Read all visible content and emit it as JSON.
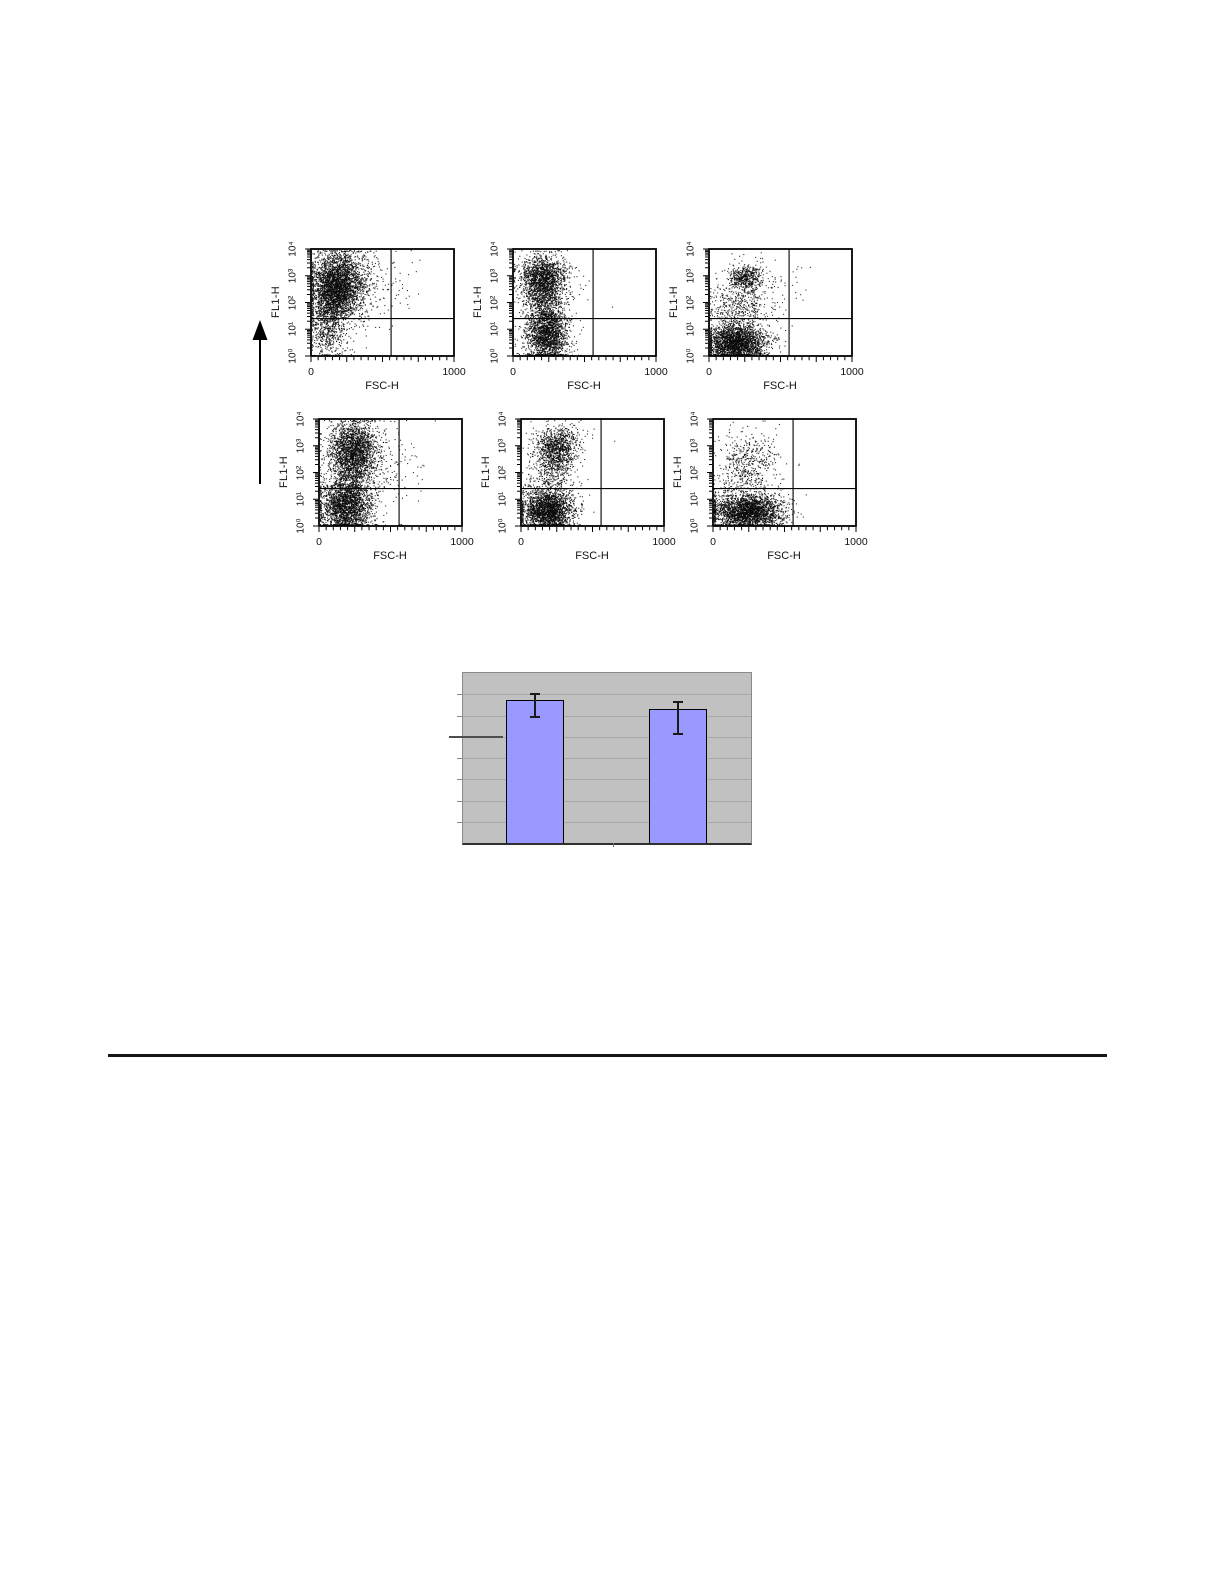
{
  "colors": {
    "page_bg": "#ffffff",
    "dot": "#0a0a0a",
    "plot_frame": "#111111",
    "bar_fill": "#9999ff",
    "bar_border": "#000000",
    "chart_bg": "#c1c1c1",
    "chart_border": "#8a8a8a",
    "gridline": "#a9a9a9",
    "separator": "#151515"
  },
  "chart_data": [
    {
      "type": "scatter",
      "subtype": "flow-cytometry-dot-plots",
      "layout_grid": "2 rows x 3 columns",
      "xlabel": "FSC-H",
      "ylabel": "FL1-H",
      "x_range": [
        0,
        1000
      ],
      "x_tick_labels": [
        "0",
        "1000"
      ],
      "y_scale": "log",
      "y_log_range": [
        0,
        4
      ],
      "y_tick_labels": [
        "10⁰",
        "10¹",
        "10²",
        "10³",
        "10⁴"
      ],
      "quadrant_gate": {
        "x": 560,
        "y_log": 1.4
      },
      "plots": [
        {
          "name": "row1-col1",
          "seed": 7,
          "clusters": [
            {
              "n": 2400,
              "cx": 185,
              "sx": 90,
              "ly": 2.75,
              "sly": 0.5
            },
            {
              "n": 900,
              "cx": 150,
              "sx": 75,
              "ly": 1.9,
              "sly": 0.45
            },
            {
              "n": 300,
              "cx": 100,
              "sx": 55,
              "ly": 1.0,
              "sly": 0.45
            },
            {
              "n": 90,
              "cx": 170,
              "sx": 60,
              "ly": 0.5,
              "sly": 0.3
            },
            {
              "n": 260,
              "cx": 330,
              "sx": 95,
              "ly": 2.5,
              "sly": 0.8
            },
            {
              "n": 120,
              "cx": 200,
              "sx": 90,
              "ly": 3.6,
              "sly": 0.25
            },
            {
              "n": 40,
              "cx": 600,
              "sx": 90,
              "ly": 2.8,
              "sly": 0.6
            }
          ]
        },
        {
          "name": "row1-col2",
          "seed": 13,
          "clusters": [
            {
              "n": 1500,
              "cx": 205,
              "sx": 80,
              "ly": 2.95,
              "sly": 0.4
            },
            {
              "n": 1700,
              "cx": 235,
              "sx": 75,
              "ly": 0.75,
              "sly": 0.5
            },
            {
              "n": 650,
              "cx": 210,
              "sx": 65,
              "ly": 1.9,
              "sly": 0.55
            },
            {
              "n": 120,
              "cx": 300,
              "sx": 130,
              "ly": 2.2,
              "sly": 1.0
            }
          ]
        },
        {
          "name": "row1-col3",
          "seed": 21,
          "clusters": [
            {
              "n": 2400,
              "cx": 190,
              "sx": 105,
              "ly": 0.5,
              "sly": 0.33
            },
            {
              "n": 420,
              "cx": 255,
              "sx": 55,
              "ly": 2.95,
              "sly": 0.22
            },
            {
              "n": 550,
              "cx": 210,
              "sx": 100,
              "ly": 1.9,
              "sly": 0.6
            },
            {
              "n": 80,
              "cx": 420,
              "sx": 120,
              "ly": 2.4,
              "sly": 0.8
            }
          ]
        },
        {
          "name": "row2-col1",
          "seed": 29,
          "clusters": [
            {
              "n": 2100,
              "cx": 185,
              "sx": 90,
              "ly": 0.75,
              "sly": 0.5
            },
            {
              "n": 1900,
              "cx": 245,
              "sx": 85,
              "ly": 2.9,
              "sly": 0.5
            },
            {
              "n": 600,
              "cx": 215,
              "sx": 85,
              "ly": 1.85,
              "sly": 0.5
            },
            {
              "n": 130,
              "cx": 500,
              "sx": 110,
              "ly": 2.3,
              "sly": 0.9
            }
          ]
        },
        {
          "name": "row2-col2",
          "seed": 35,
          "clusters": [
            {
              "n": 2300,
              "cx": 185,
              "sx": 90,
              "ly": 0.6,
              "sly": 0.4
            },
            {
              "n": 950,
              "cx": 245,
              "sx": 75,
              "ly": 2.9,
              "sly": 0.42
            },
            {
              "n": 280,
              "cx": 200,
              "sx": 80,
              "ly": 1.9,
              "sly": 0.5
            },
            {
              "n": 60,
              "cx": 330,
              "sx": 130,
              "ly": 3.3,
              "sly": 0.3
            }
          ]
        },
        {
          "name": "row2-col3",
          "seed": 43,
          "clusters": [
            {
              "n": 2600,
              "cx": 235,
              "sx": 125,
              "ly": 0.55,
              "sly": 0.33
            },
            {
              "n": 380,
              "cx": 255,
              "sx": 105,
              "ly": 2.55,
              "sly": 0.5
            },
            {
              "n": 160,
              "cx": 200,
              "sx": 110,
              "ly": 1.6,
              "sly": 0.4
            }
          ]
        }
      ]
    },
    {
      "type": "bar",
      "title": "",
      "xlabel": "",
      "ylabel": "",
      "categories": [
        "",
        ""
      ],
      "values": [
        0.84,
        0.787
      ],
      "error_whisker_top": [
        0.875,
        0.83
      ],
      "error_whisker_bottom": [
        0.74,
        0.64
      ],
      "value_unit": "fraction of plot height",
      "axis_tick_labels_visible": false,
      "gridline_count": 7,
      "legend": "none"
    }
  ]
}
